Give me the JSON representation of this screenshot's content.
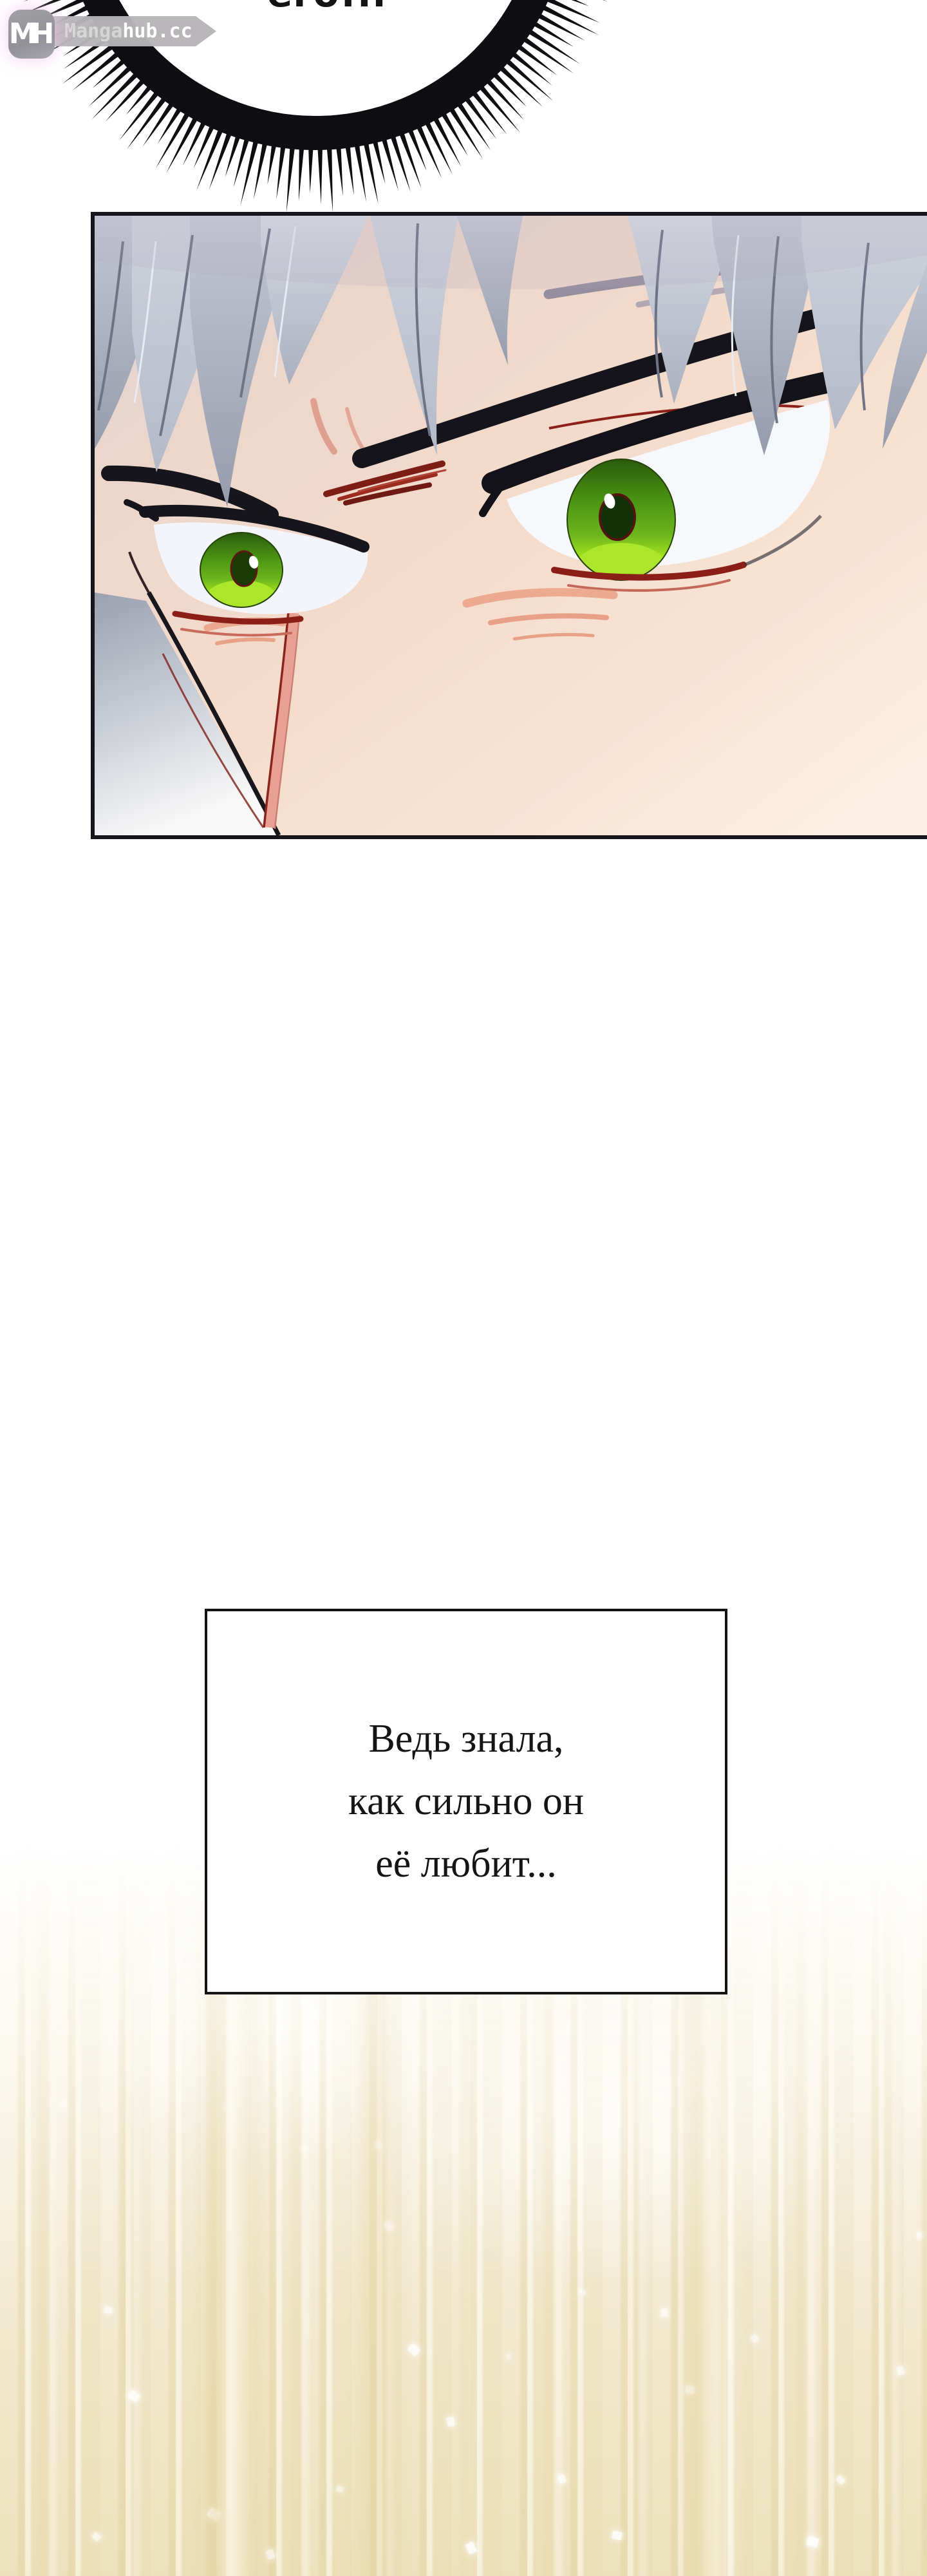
{
  "watermark": {
    "monogram_m": "M",
    "monogram_h": "H",
    "site_prefix": "Manga",
    "site_suffix": "hub.cc"
  },
  "speech_bubble": {
    "text": "его!.."
  },
  "narration_box": {
    "line1": "Ведь знала,",
    "line2": "как сильно он",
    "line3": "её любит..."
  },
  "palette": {
    "iris_green": "#6cb41d",
    "iris_bright": "#abe62a",
    "hair_silver": "#c3c8d4",
    "lash_black": "#14141a",
    "accent_red": "#8c1e18",
    "skin_tone": "#f4dccc",
    "gold_streak": "#e6d5a7",
    "panel_border": "#16161c",
    "watermark_glow": "#f3c4ec"
  }
}
